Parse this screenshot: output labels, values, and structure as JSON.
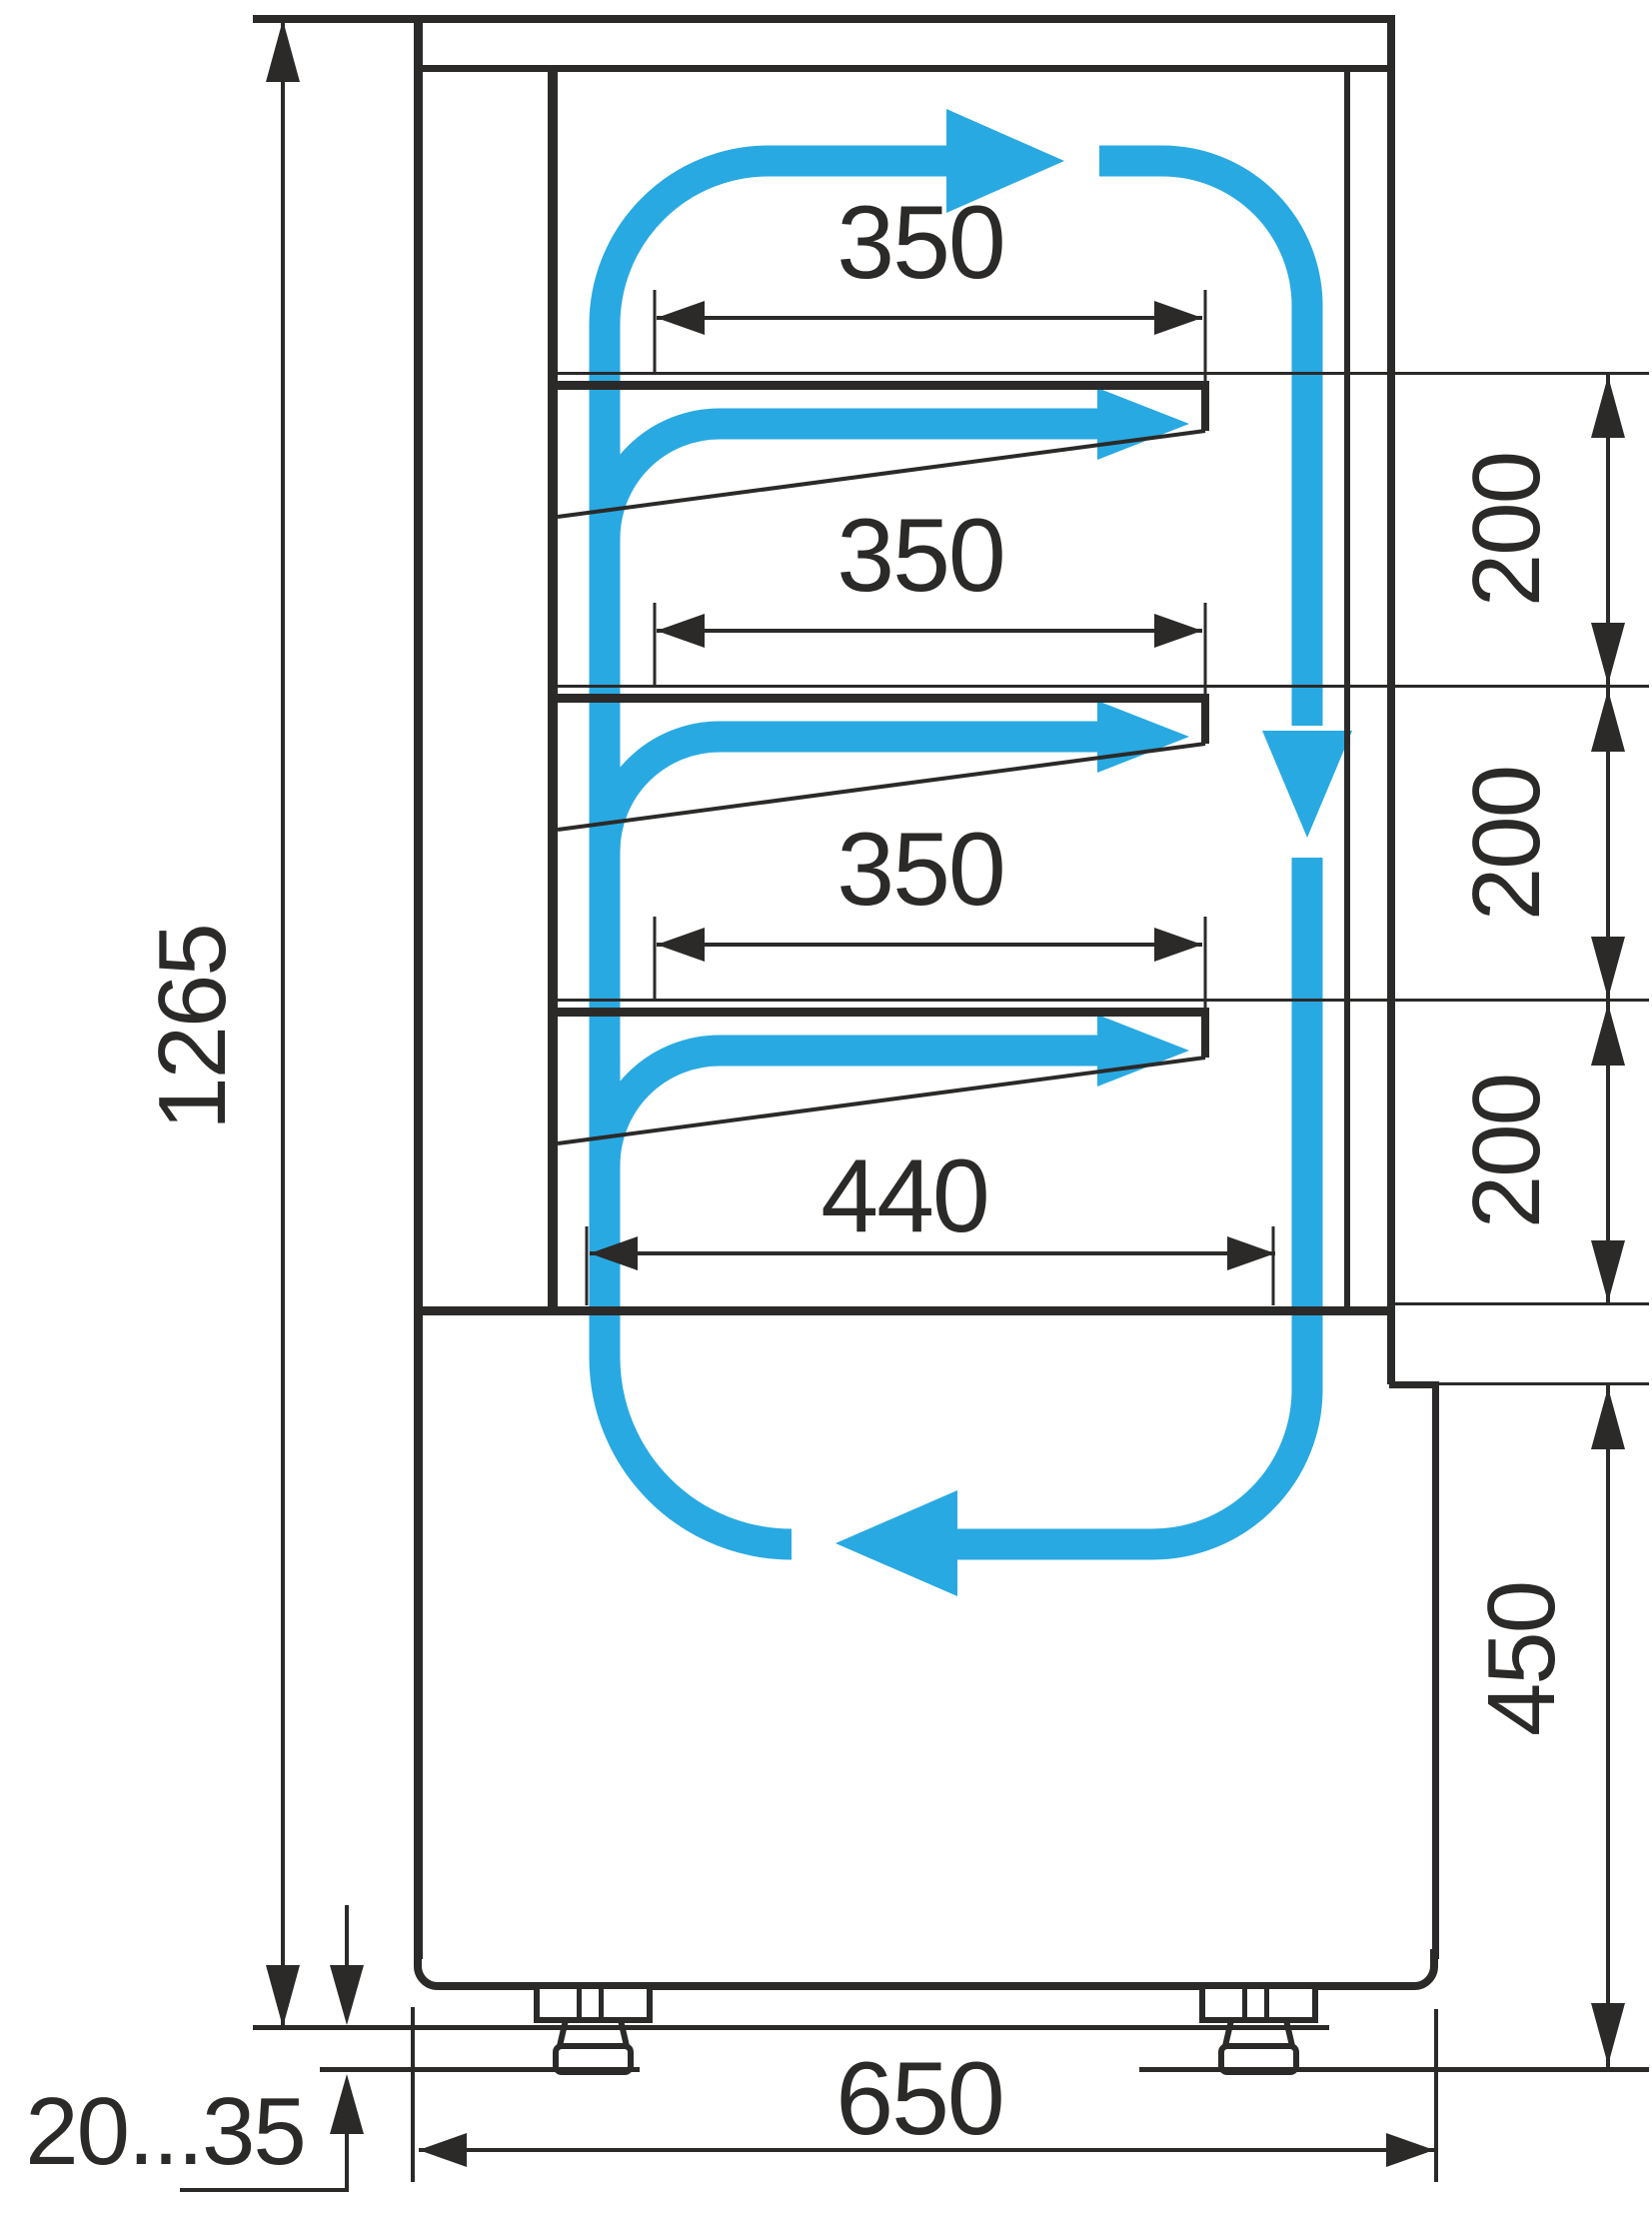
{
  "diagram": {
    "type": "technical-drawing",
    "subject": "refrigerated display case side cross-section with air circulation arrows",
    "colors": {
      "line": "#2b2a29",
      "flow": "#29a9e2",
      "background": "#ffffff"
    },
    "labels": {
      "overall_height": "1265",
      "shelf1_width": "350",
      "shelf2_width": "350",
      "shelf3_width": "350",
      "deck_width": "440",
      "gap1": "200",
      "gap2": "200",
      "gap3": "200",
      "base_front_height": "450",
      "base_depth": "650",
      "leg_adjust_range": "20...35"
    }
  }
}
